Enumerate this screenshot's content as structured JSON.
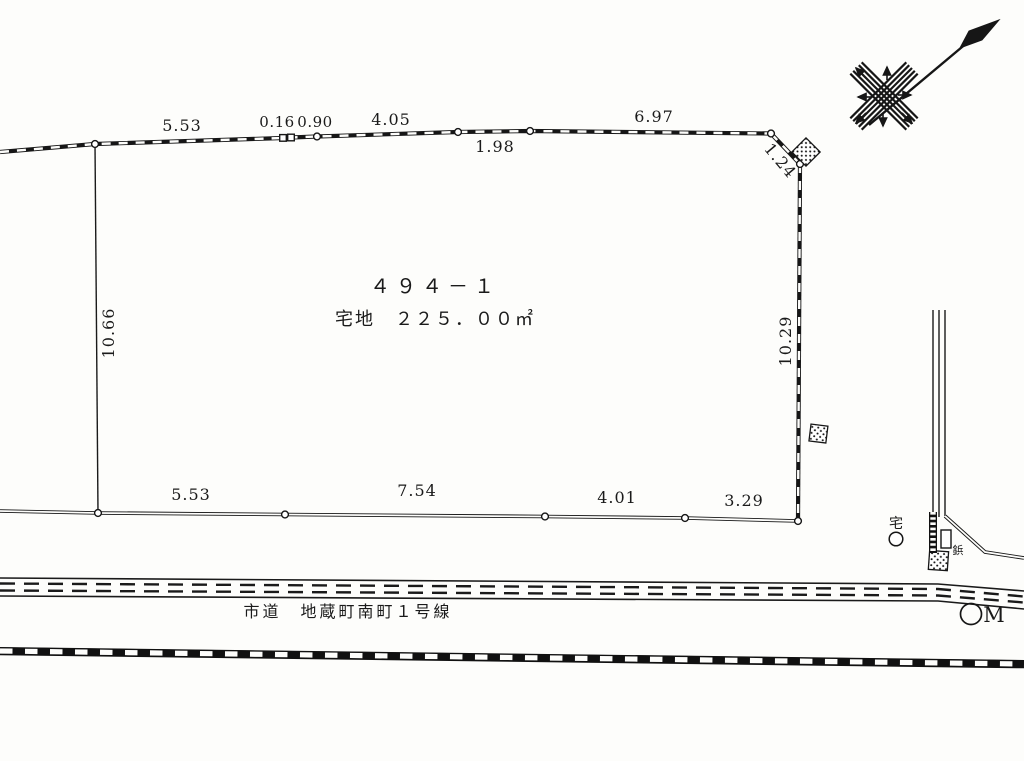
{
  "parcel": {
    "number": "４９４－１",
    "category_area": "宅地　２２５．００㎡"
  },
  "dimensions": {
    "top": [
      "5.53",
      "0.16",
      "0.90",
      "4.05",
      "1.98",
      "6.97",
      "1.24"
    ],
    "left": "10.66",
    "right": "10.29",
    "bottom": [
      "5.53",
      "7.54",
      "4.01",
      "3.29"
    ]
  },
  "road": {
    "label": "市道　地蔵町南町１号線"
  },
  "markers": {
    "house_label": "宅",
    "benchmark_label": "M",
    "pin_label": "鋲"
  },
  "colors": {
    "ink": "#1a1a1a",
    "paper": "#fdfdfb"
  }
}
